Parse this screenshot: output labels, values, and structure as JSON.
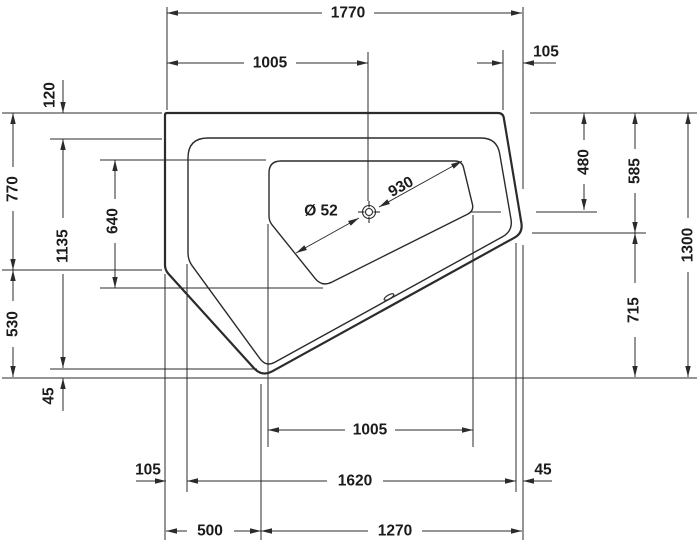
{
  "drawing": {
    "type": "technical-dimension-drawing",
    "subject": "corner-bathtub-plan-view",
    "units": "mm",
    "canvas": {
      "width": 700,
      "height": 547,
      "background": "#ffffff"
    },
    "style": {
      "line_color": "#2b2b2b",
      "text_color": "#1b1b1b",
      "outline_stroke": 2.2,
      "contour_stroke": 1.4,
      "dim_stroke": 1.0,
      "font_size": 15.5,
      "arrow_len": 11,
      "arrow_halfwidth": 2.7
    },
    "shapes": {
      "tub_outer": {
        "pts": [
          [
            165,
            113
          ],
          [
            503,
            113
          ],
          [
            523,
            233
          ],
          [
            262,
            377
          ],
          [
            165,
            270
          ]
        ],
        "radii": [
          2,
          5,
          10,
          12,
          5
        ]
      },
      "tub_rim": {
        "pts": [
          [
            188,
            138
          ],
          [
            497,
            138
          ],
          [
            513,
            231
          ],
          [
            266,
            367
          ],
          [
            188,
            260
          ]
        ],
        "radii": [
          20,
          16,
          12,
          10,
          7
        ]
      },
      "basin": {
        "pts": [
          [
            269,
            161
          ],
          [
            462,
            161
          ],
          [
            474,
            211
          ],
          [
            322,
            287
          ],
          [
            269,
            221
          ]
        ],
        "radii": [
          12,
          7,
          7,
          11,
          5
        ]
      },
      "drain": {
        "cx": 369,
        "cy": 212,
        "r_outer": 6.5,
        "r_inner": 3.5,
        "tick_in": 4.5,
        "tick_out": 11
      },
      "overflow": {
        "cx": 389,
        "cy": 297,
        "rx": 5.5,
        "ry": 2,
        "rot": -30
      }
    },
    "extension_lines": [
      [
        167,
        7,
        167,
        110
      ],
      [
        368,
        52,
        368,
        201
      ],
      [
        503,
        50,
        503,
        110
      ],
      [
        523,
        7,
        523,
        189
      ],
      [
        523,
        245,
        523,
        540
      ],
      [
        165,
        274,
        165,
        540
      ],
      [
        187,
        264,
        187,
        492
      ],
      [
        261,
        384,
        261,
        540
      ],
      [
        268,
        224,
        268,
        447
      ],
      [
        473,
        215,
        473,
        447
      ],
      [
        516,
        243,
        516,
        492
      ],
      [
        2,
        113,
        162,
        113
      ],
      [
        50,
        139,
        162,
        139
      ],
      [
        100,
        160,
        266,
        160
      ],
      [
        2,
        270,
        162,
        270
      ],
      [
        100,
        288,
        323,
        288
      ],
      [
        50,
        369,
        257,
        369
      ],
      [
        2,
        378,
        697,
        378
      ],
      [
        530,
        113,
        697,
        113
      ],
      [
        470,
        212,
        501,
        212
      ],
      [
        536,
        212,
        597,
        212
      ],
      [
        532,
        233,
        646,
        233
      ]
    ],
    "annotations": [
      {
        "label": "1770",
        "value": 1770,
        "x": 348,
        "y": 13,
        "rot": 0,
        "segs": [
          [
            167,
            13,
            322,
            13
          ],
          [
            374,
            13,
            522,
            13
          ]
        ],
        "arrows": [
          [
            167,
            13,
            180
          ],
          [
            522,
            13,
            0
          ]
        ]
      },
      {
        "label": "1005",
        "value": 1005,
        "x": 270,
        "y": 63,
        "rot": 0,
        "segs": [
          [
            167,
            63,
            244,
            63
          ],
          [
            296,
            63,
            368,
            63
          ]
        ],
        "arrows": [
          [
            167,
            63,
            180
          ],
          [
            368,
            63,
            0
          ]
        ]
      },
      {
        "label": "105",
        "value": 105,
        "x": 546,
        "y": 52,
        "rot": 0,
        "segs": [
          [
            477,
            63,
            503,
            63
          ],
          [
            523,
            63,
            556,
            63
          ]
        ],
        "arrows": [
          [
            503,
            63,
            0
          ],
          [
            523,
            63,
            180
          ]
        ]
      },
      {
        "label": "120",
        "value": 120,
        "x": 50,
        "y": 95,
        "rot": -90,
        "segs": [
          [
            63,
            80,
            63,
            113
          ]
        ],
        "arrows": [
          [
            63,
            113,
            90
          ]
        ]
      },
      {
        "label": "770",
        "value": 770,
        "x": 13,
        "y": 189,
        "rot": -90,
        "segs": [
          [
            13,
            113,
            13,
            167
          ],
          [
            13,
            211,
            13,
            270
          ]
        ],
        "arrows": [
          [
            13,
            113,
            -90
          ],
          [
            13,
            270,
            90
          ]
        ]
      },
      {
        "label": "1135",
        "value": 1135,
        "x": 63,
        "y": 246,
        "rot": -90,
        "segs": [
          [
            63,
            139,
            63,
            218
          ],
          [
            63,
            274,
            63,
            368
          ]
        ],
        "arrows": [
          [
            63,
            139,
            -90
          ],
          [
            63,
            368,
            90
          ]
        ]
      },
      {
        "label": "530",
        "value": 530,
        "x": 13,
        "y": 324,
        "rot": -90,
        "segs": [
          [
            13,
            270,
            13,
            301
          ],
          [
            13,
            347,
            13,
            377
          ]
        ],
        "arrows": [
          [
            13,
            270,
            -90
          ],
          [
            13,
            377,
            90
          ]
        ]
      },
      {
        "label": "45",
        "value": 45,
        "x": 49,
        "y": 396,
        "rot": -90,
        "segs": [
          [
            63,
            378,
            63,
            411
          ]
        ],
        "arrows": [
          [
            63,
            378,
            -90
          ]
        ]
      },
      {
        "label": "640",
        "value": 640,
        "x": 113,
        "y": 221,
        "rot": -90,
        "segs": [
          [
            115,
            160,
            115,
            199
          ],
          [
            115,
            243,
            115,
            288
          ]
        ],
        "arrows": [
          [
            115,
            160,
            -90
          ],
          [
            115,
            288,
            90
          ]
        ]
      },
      {
        "label": "480",
        "value": 480,
        "x": 584,
        "y": 162,
        "rot": -90,
        "segs": [
          [
            584,
            113,
            584,
            140
          ],
          [
            584,
            184,
            584,
            210
          ]
        ],
        "arrows": [
          [
            584,
            113,
            -90
          ],
          [
            584,
            210,
            90
          ]
        ]
      },
      {
        "label": "585",
        "value": 585,
        "x": 635,
        "y": 171,
        "rot": -90,
        "segs": [
          [
            635,
            113,
            635,
            149
          ],
          [
            635,
            193,
            635,
            233
          ]
        ],
        "arrows": [
          [
            635,
            113,
            -90
          ],
          [
            635,
            233,
            90
          ]
        ]
      },
      {
        "label": "1300",
        "value": 1300,
        "x": 688,
        "y": 245,
        "rot": -90,
        "segs": [
          [
            688,
            113,
            688,
            218
          ],
          [
            688,
            272,
            688,
            377
          ]
        ],
        "arrows": [
          [
            688,
            113,
            -90
          ],
          [
            688,
            377,
            90
          ]
        ]
      },
      {
        "label": "715",
        "value": 715,
        "x": 634,
        "y": 310,
        "rot": -90,
        "segs": [
          [
            635,
            233,
            635,
            283
          ],
          [
            635,
            337,
            635,
            377
          ]
        ],
        "arrows": [
          [
            635,
            233,
            -90
          ],
          [
            635,
            377,
            90
          ]
        ]
      },
      {
        "label": "930",
        "value": 930,
        "x": 401,
        "y": 187,
        "rot": -29,
        "segs": [
          [
            296,
            253,
            359,
            218
          ],
          [
            379,
            207,
            462,
            161
          ]
        ],
        "arrows": [
          [
            296,
            253,
            151
          ],
          [
            359,
            218,
            -29
          ],
          [
            379,
            207,
            151
          ],
          [
            462,
            161,
            -29
          ]
        ]
      },
      {
        "label": "Ø 52",
        "value": 52,
        "x": 321,
        "y": 211,
        "rot": 0,
        "segs": [],
        "arrows": []
      },
      {
        "label": "1005",
        "value": 1005,
        "x": 370,
        "y": 430,
        "rot": 0,
        "segs": [
          [
            268,
            430,
            345,
            430
          ],
          [
            395,
            430,
            473,
            430
          ]
        ],
        "arrows": [
          [
            268,
            430,
            180
          ],
          [
            473,
            430,
            0
          ]
        ]
      },
      {
        "label": "105",
        "value": 105,
        "x": 148,
        "y": 470,
        "rot": 0,
        "segs": [
          [
            136,
            481,
            166,
            481
          ]
        ],
        "arrows": [
          [
            166,
            481,
            0
          ]
        ]
      },
      {
        "label": "1620",
        "value": 1620,
        "x": 355,
        "y": 481,
        "rot": 0,
        "segs": [
          [
            187,
            481,
            327,
            481
          ],
          [
            383,
            481,
            516,
            481
          ]
        ],
        "arrows": [
          [
            187,
            481,
            180
          ],
          [
            516,
            481,
            0
          ]
        ]
      },
      {
        "label": "45",
        "value": 45,
        "x": 543,
        "y": 470,
        "rot": 0,
        "segs": [
          [
            523,
            481,
            552,
            481
          ]
        ],
        "arrows": [
          [
            523,
            481,
            180
          ]
        ]
      },
      {
        "label": "500",
        "value": 500,
        "x": 210,
        "y": 531,
        "rot": 0,
        "segs": [
          [
            166,
            531,
            187,
            531
          ],
          [
            234,
            531,
            261,
            531
          ]
        ],
        "arrows": [
          [
            166,
            531,
            180
          ],
          [
            261,
            531,
            0
          ]
        ]
      },
      {
        "label": "1270",
        "value": 1270,
        "x": 395,
        "y": 531,
        "rot": 0,
        "segs": [
          [
            261,
            531,
            368,
            531
          ],
          [
            422,
            531,
            522,
            531
          ]
        ],
        "arrows": [
          [
            261,
            531,
            180
          ],
          [
            522,
            531,
            0
          ]
        ]
      }
    ]
  }
}
